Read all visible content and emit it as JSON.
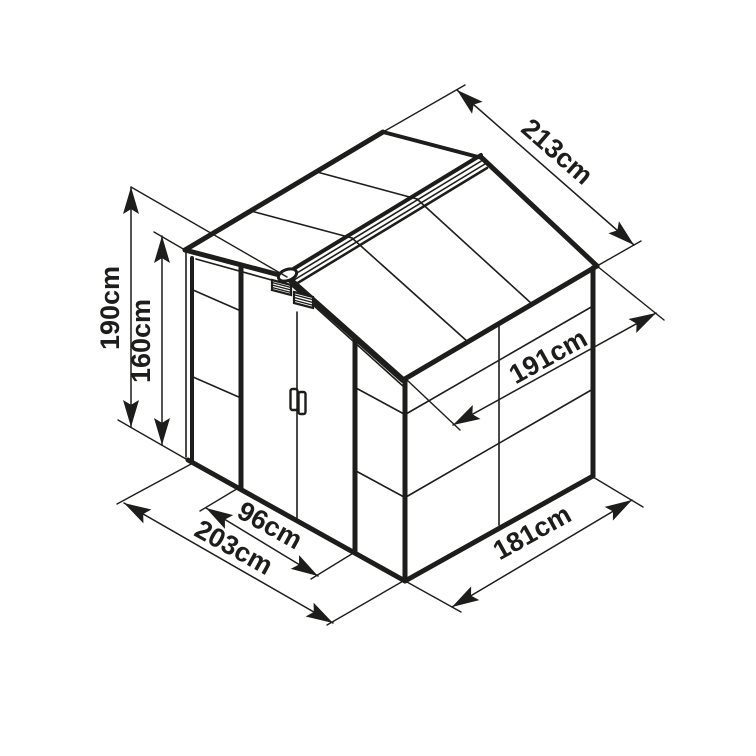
{
  "diagram": {
    "description": "isometric-shed-dimension-drawing",
    "canvas": {
      "width": 756,
      "height": 756,
      "background": "#ffffff",
      "ink": "#1d1d1b"
    },
    "label_font_size": 27,
    "arrow": {
      "length": 27,
      "half_width": 8
    },
    "dimensions": [
      {
        "id": "190cm",
        "label": "190cm",
        "line": [
          131,
          427,
          131,
          187
        ],
        "label_pos": [
          112,
          308
        ],
        "label_rot": -90
      },
      {
        "id": "160cm",
        "label": "160cm",
        "line": [
          162,
          445,
          162,
          236
        ],
        "label_pos": [
          143,
          341
        ],
        "label_rot": -90
      },
      {
        "id": "213cm",
        "label": "213cm",
        "line": [
          457,
          90,
          634,
          245
        ],
        "label_pos": [
          556,
          153
        ],
        "label_rot": 41
      },
      {
        "id": "191cm",
        "label": "191cm",
        "line": [
          453,
          425,
          656,
          313
        ],
        "label_pos": [
          549,
          358
        ],
        "label_rot": -29
      },
      {
        "id": "96cm",
        "label": "96cm",
        "line": [
          206,
          508,
          318,
          576
        ],
        "label_pos": [
          269,
          527
        ],
        "label_rot": 29
      },
      {
        "id": "203cm",
        "label": "203cm",
        "line": [
          124,
          503,
          333,
          623
        ],
        "label_pos": [
          233,
          549
        ],
        "label_rot": 29
      },
      {
        "id": "181cm",
        "label": "181cm",
        "line": [
          452,
          607,
          632,
          500
        ],
        "label_pos": [
          533,
          534
        ],
        "label_rot": -29
      }
    ],
    "extension_lines": [
      [
        287,
        277,
        131,
        187
      ],
      [
        185,
        250,
        154,
        232
      ],
      [
        193,
        463,
        118,
        420
      ],
      [
        383,
        132,
        465,
        85
      ],
      [
        597,
        266,
        641,
        241
      ],
      [
        407,
        380,
        460,
        430
      ],
      [
        597,
        266,
        664,
        320
      ],
      [
        240,
        487,
        200,
        511
      ],
      [
        355,
        552,
        311,
        579
      ],
      [
        193,
        463,
        117,
        504
      ],
      [
        405,
        580,
        327,
        625
      ],
      [
        407,
        582,
        461,
        612
      ],
      [
        593,
        477,
        643,
        507
      ]
    ],
    "shed": {
      "thick_lines": [
        [
          185,
          250,
          383,
          132,
          5
        ],
        [
          383,
          132,
          482,
          158,
          4
        ],
        [
          482,
          158,
          597,
          266,
          5
        ],
        [
          597,
          266,
          403,
          380,
          5
        ],
        [
          403,
          380,
          287,
          277,
          6
        ],
        [
          287,
          277,
          185,
          250,
          5
        ],
        [
          290,
          271,
          481,
          155,
          4
        ],
        [
          296,
          284,
          487,
          168,
          2.5
        ],
        [
          192,
          258,
          192,
          462,
          4
        ],
        [
          188,
          460,
          405,
          581,
          5
        ],
        [
          405,
          380,
          405,
          581,
          5
        ],
        [
          405,
          581,
          593,
          476,
          5
        ],
        [
          593,
          268,
          593,
          476,
          5
        ],
        [
          241,
          265,
          241,
          489,
          5
        ],
        [
          355,
          339,
          355,
          553,
          5
        ]
      ],
      "thin_lines": [
        [
          186,
          252,
          186,
          457
        ],
        [
          193,
          290,
          241,
          311
        ],
        [
          193,
          377,
          241,
          398
        ],
        [
          356,
          388,
          404,
          414
        ],
        [
          356,
          471,
          404,
          497
        ],
        [
          297,
          312,
          297,
          519
        ],
        [
          292,
          286,
          404,
          387
        ],
        [
          196,
          259,
          286,
          284
        ],
        [
          499,
          325,
          499,
          525
        ],
        [
          406,
          414,
          593,
          306
        ],
        [
          406,
          497,
          593,
          389
        ],
        [
          251,
          211,
          352,
          238
        ],
        [
          317,
          172,
          417,
          199
        ],
        [
          352,
          238,
          468,
          342
        ],
        [
          417,
          199,
          532,
          304
        ],
        [
          292,
          276,
          483,
          160
        ],
        [
          294,
          280,
          485,
          164
        ]
      ],
      "vents": [
        {
          "quad": [
            [
              272,
              280
            ],
            [
              291,
              285
            ],
            [
              291,
              295
            ],
            [
              272,
              290
            ]
          ]
        },
        {
          "quad": [
            [
              294,
              292
            ],
            [
              313,
              297
            ],
            [
              313,
              308
            ],
            [
              294,
              303
            ]
          ]
        }
      ],
      "handle_plates": [
        {
          "x": 290.5,
          "y": 389,
          "w": 7,
          "h": 21
        },
        {
          "x": 298.5,
          "y": 392,
          "w": 7,
          "h": 22
        }
      ],
      "ridge_cap": {
        "cx": 287.5,
        "cy": 275,
        "rx": 9.5,
        "ry": 5.5,
        "rot": -20
      }
    }
  }
}
